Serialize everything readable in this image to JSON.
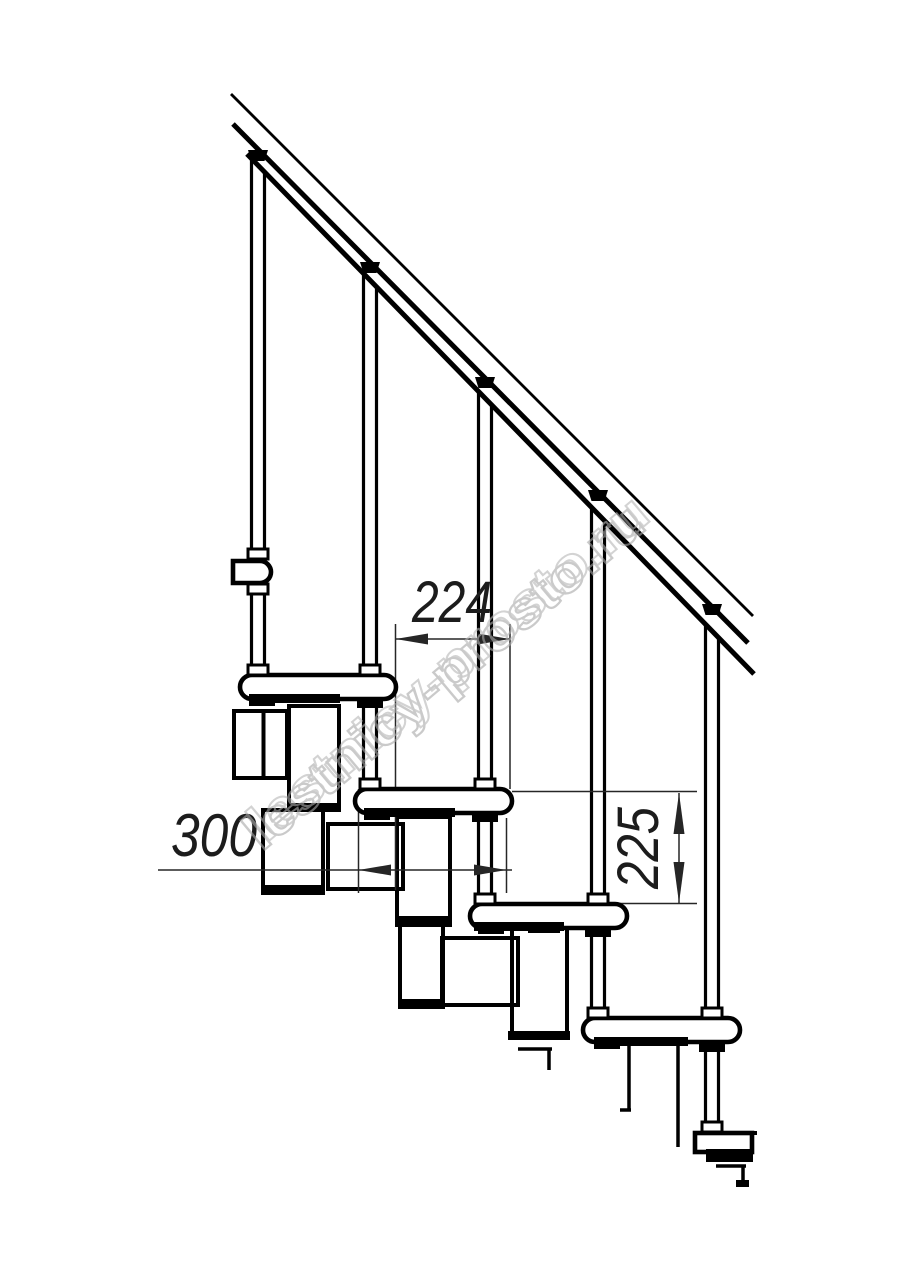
{
  "drawing": {
    "watermark": "lestnicy-prosto.ru",
    "dimensions": {
      "step_run": "224",
      "tread_depth": "300",
      "step_rise": "225"
    },
    "colors": {
      "line": "#000000",
      "dimension": "#262626",
      "watermark": "#a8a8a8",
      "background": "#ffffff"
    }
  }
}
